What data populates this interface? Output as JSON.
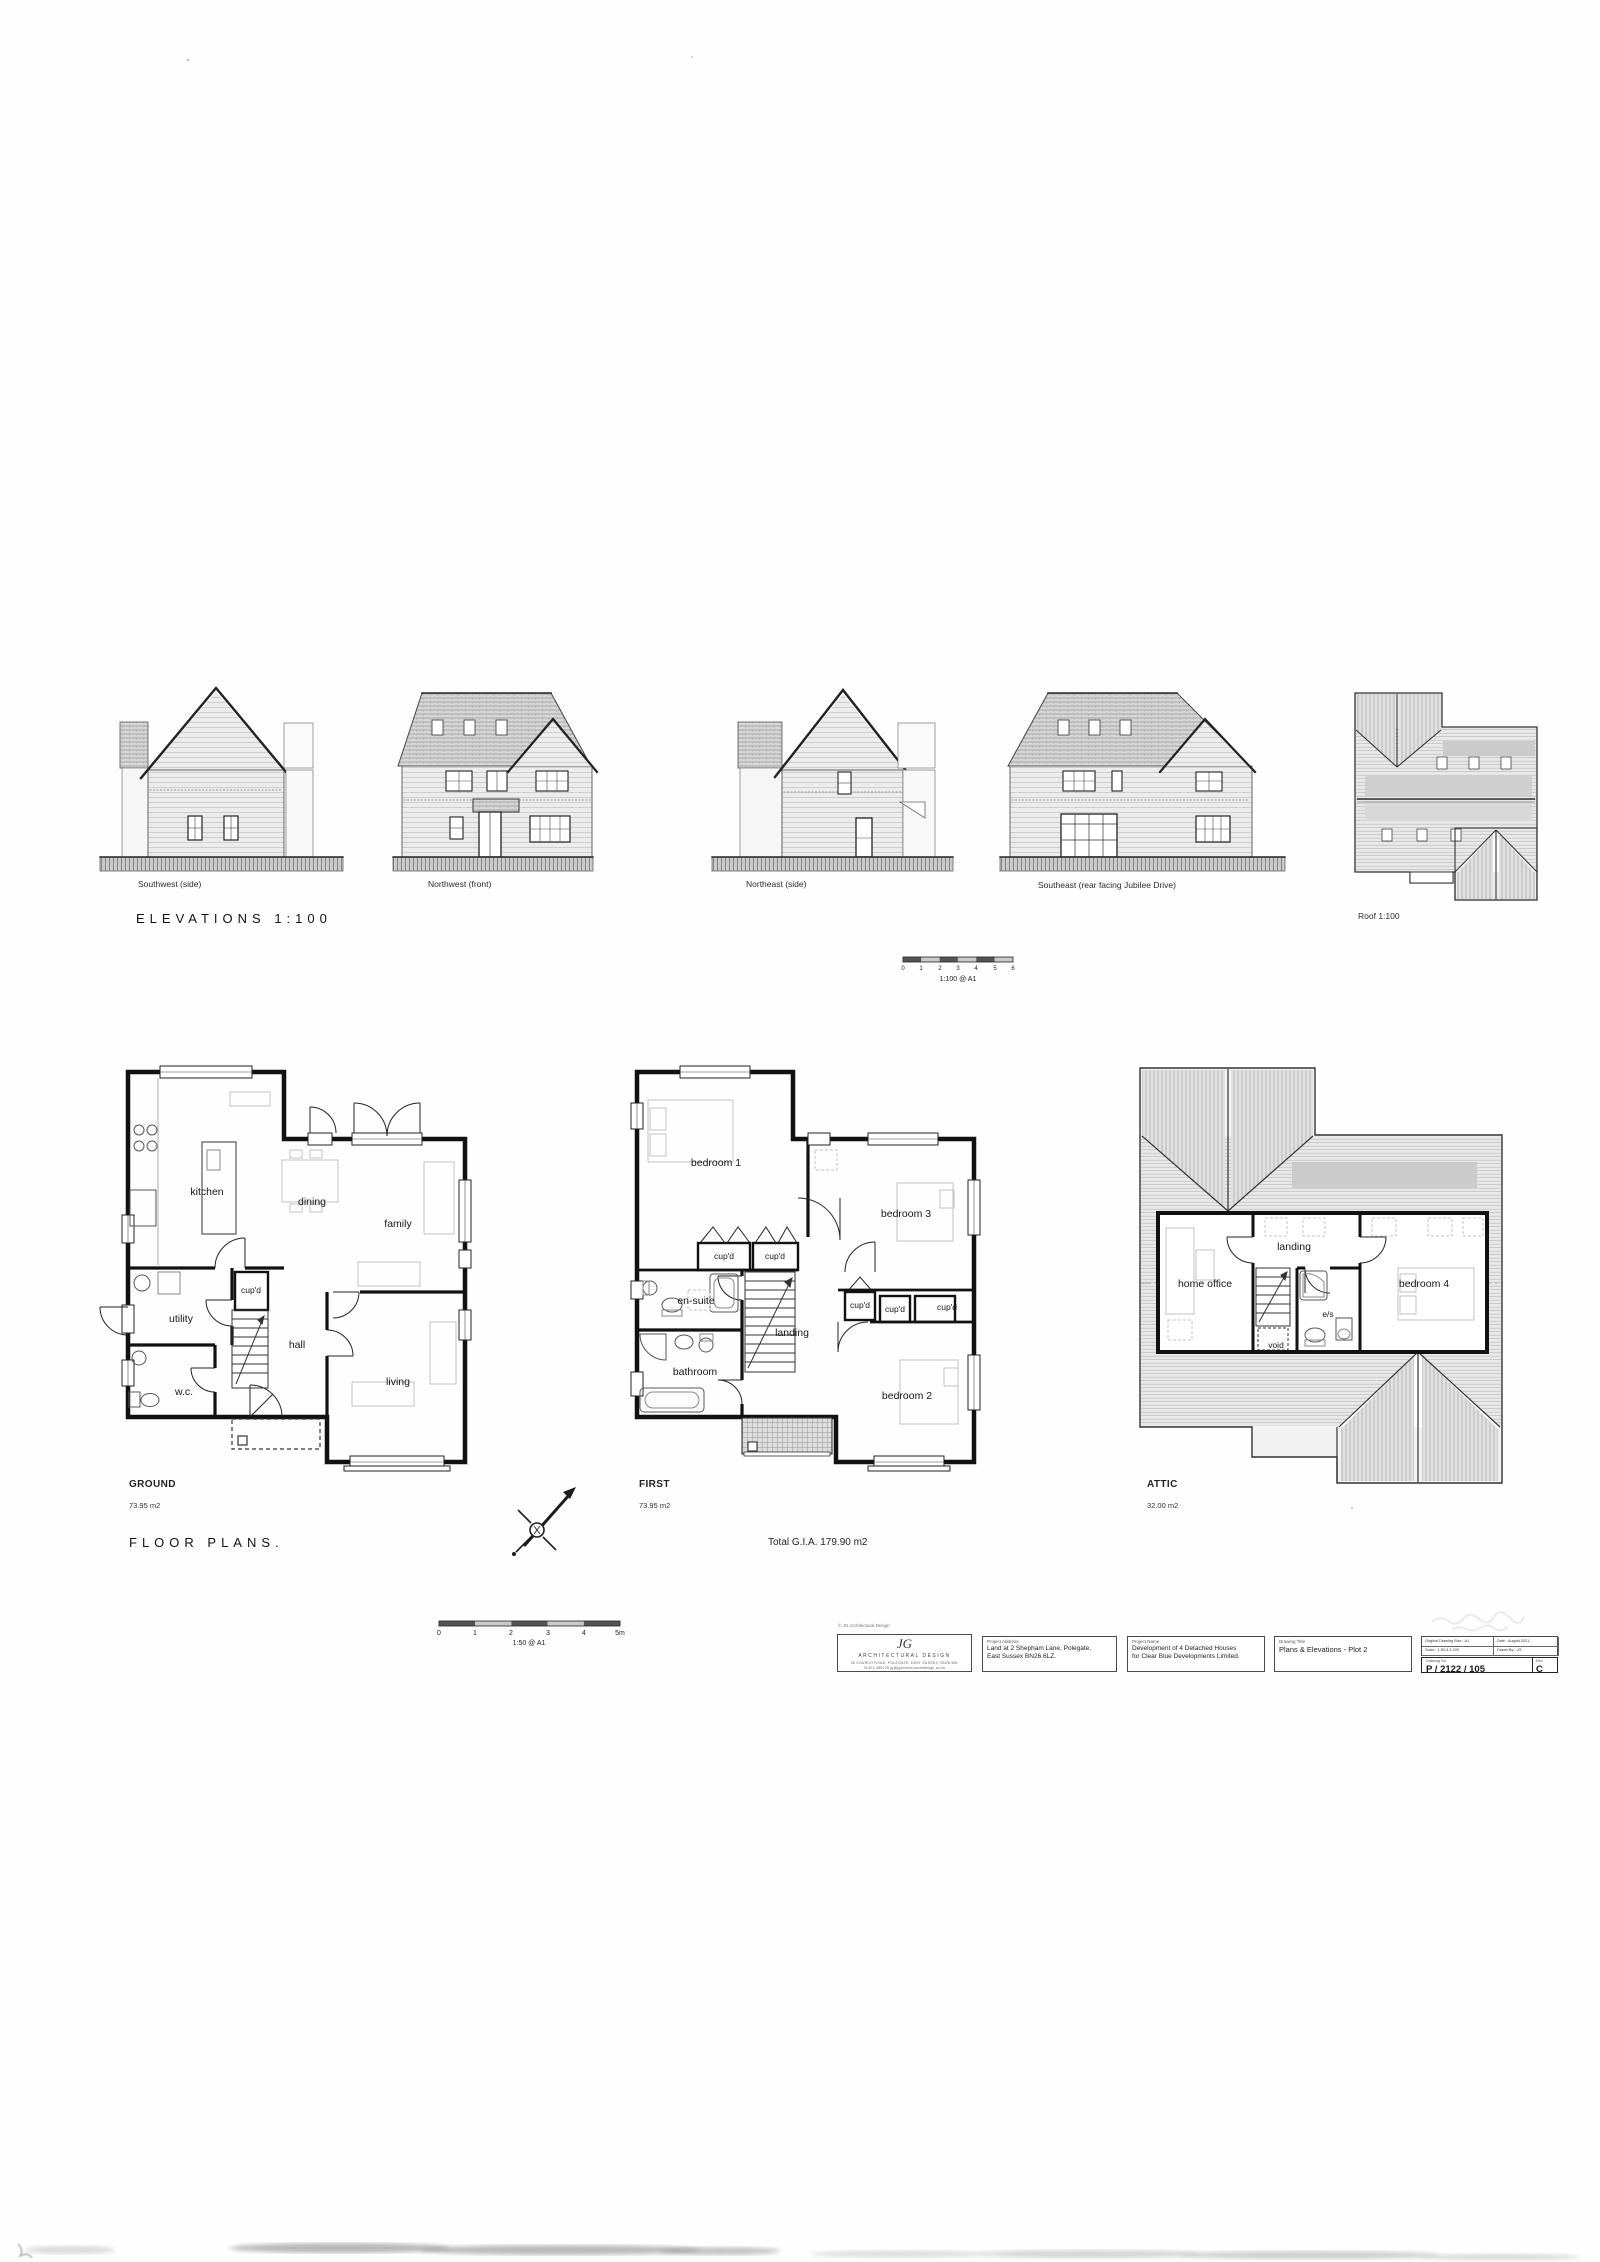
{
  "elevations": {
    "section_title": "ELEVATIONS 1:100",
    "items": [
      {
        "label": "Southwest (side)"
      },
      {
        "label": "Northwest (front)"
      },
      {
        "label": "Northeast (side)"
      },
      {
        "label": "Southeast (rear facing Jubilee Drive)"
      },
      {
        "label": "Roof 1:100"
      }
    ],
    "scale_bar": {
      "ticks": [
        "0",
        "1",
        "2",
        "3",
        "4",
        "5",
        "6"
      ],
      "caption": "1:100 @ A1"
    }
  },
  "floor_plans": {
    "section_title": "FLOOR PLANS.",
    "total_area": "Total G.I.A. 179.90 m2",
    "scale_bar": {
      "ticks": [
        "0",
        "1",
        "2",
        "3",
        "4",
        "5m"
      ],
      "caption": "1:50 @ A1"
    },
    "ground": {
      "name": "GROUND",
      "area": "73.95 m2",
      "rooms": {
        "kitchen": "kitchen",
        "dining": "dining",
        "family": "family",
        "cupd": "cup'd",
        "utility": "utility",
        "hall": "hall",
        "wc": "w.c.",
        "living": "living"
      }
    },
    "first": {
      "name": "FIRST",
      "area": "73.95 m2",
      "rooms": {
        "bedroom1": "bedroom 1",
        "bedroom3": "bedroom 3",
        "cupd1": "cup'd",
        "cupd2": "cup'd",
        "ensuite": "en-suite",
        "landing": "landing",
        "cupd3": "cup'd",
        "cupd4": "cup'd",
        "cupd5": "cup'd",
        "bathroom": "bathroom",
        "bedroom2": "bedroom 2"
      }
    },
    "attic": {
      "name": "ATTIC",
      "area": "32.00 m2",
      "rooms": {
        "landing": "landing",
        "home_office": "home office",
        "bedroom4": "bedroom 4",
        "es": "e/s",
        "void": "void"
      }
    }
  },
  "title_block": {
    "copyright": "© JG Architectural Design",
    "logo": {
      "initials": "JG",
      "name": "ARCHITECTURAL DESIGN",
      "address": "36 CHURCH ROAD, POLEGATE, EAST SUSSEX, BN26 5BL",
      "contact": "01323 489139   jg@jgarchitecturaldesign.co.uk"
    },
    "project_address": {
      "label": "Project Address",
      "line1": "Land at 2 Shepham Lane, Polegate,",
      "line2": "East Sussex BN26 6LZ."
    },
    "project_name": {
      "label": "Project Name",
      "line1": "Development of 4 Detached Houses",
      "line2": "for Clear Blue Developments Limited."
    },
    "drawing_title": {
      "label": "Drawing Title",
      "value": "Plans & Elevations - Plot 2"
    },
    "info": {
      "size_label": "Original Drawing Size :",
      "size_value": "A1",
      "date_label": "Date :",
      "date_value": "August 2021",
      "scale_label": "Scale :",
      "scale_value": "1:50 & 1:100",
      "drawn_label": "Drawn By :",
      "drawn_value": "JG"
    },
    "drawing_no": {
      "label": "Drawing No",
      "value": "P / 2122 / 105",
      "rev_label": "Rev",
      "rev_value": "C"
    }
  }
}
